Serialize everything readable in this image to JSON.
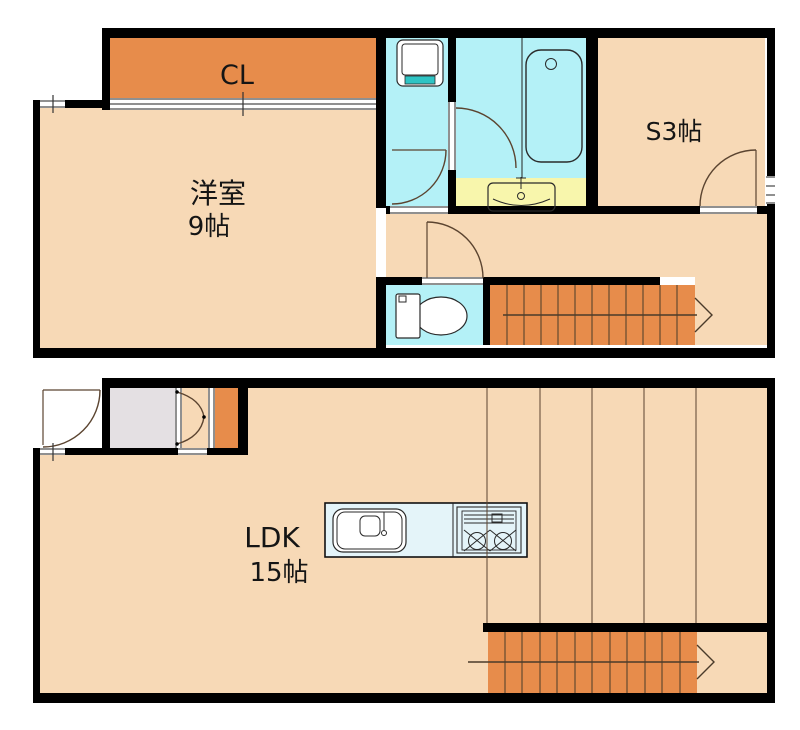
{
  "plan_type": "floor-plan",
  "rooms": {
    "closet_label": "CL",
    "western_label": "洋室",
    "western_size": "9帖",
    "service_label": "S3帖",
    "ldk_label": "LDK",
    "ldk_size": "15帖"
  },
  "fixtures": [
    "washing-machine-pan",
    "bathtub",
    "washbasin-vanity",
    "toilet",
    "kitchen-sink",
    "gas-stove",
    "staircase-upper-floor",
    "staircase-lower-floor",
    "entrance-door",
    "bifold-closet-door"
  ],
  "colors": {
    "wall": "#000000",
    "room_peach": "#F7D9B6",
    "accent_orange": "#E78C4B",
    "water_cyan": "#B4F1F7",
    "counter_blue": "#E4F4F9",
    "vanity_yellow": "#F8F6AC",
    "entry_gray": "#E4E0E3",
    "washer_teal": "#2FC4C4",
    "line_brown": "#5B4430"
  }
}
